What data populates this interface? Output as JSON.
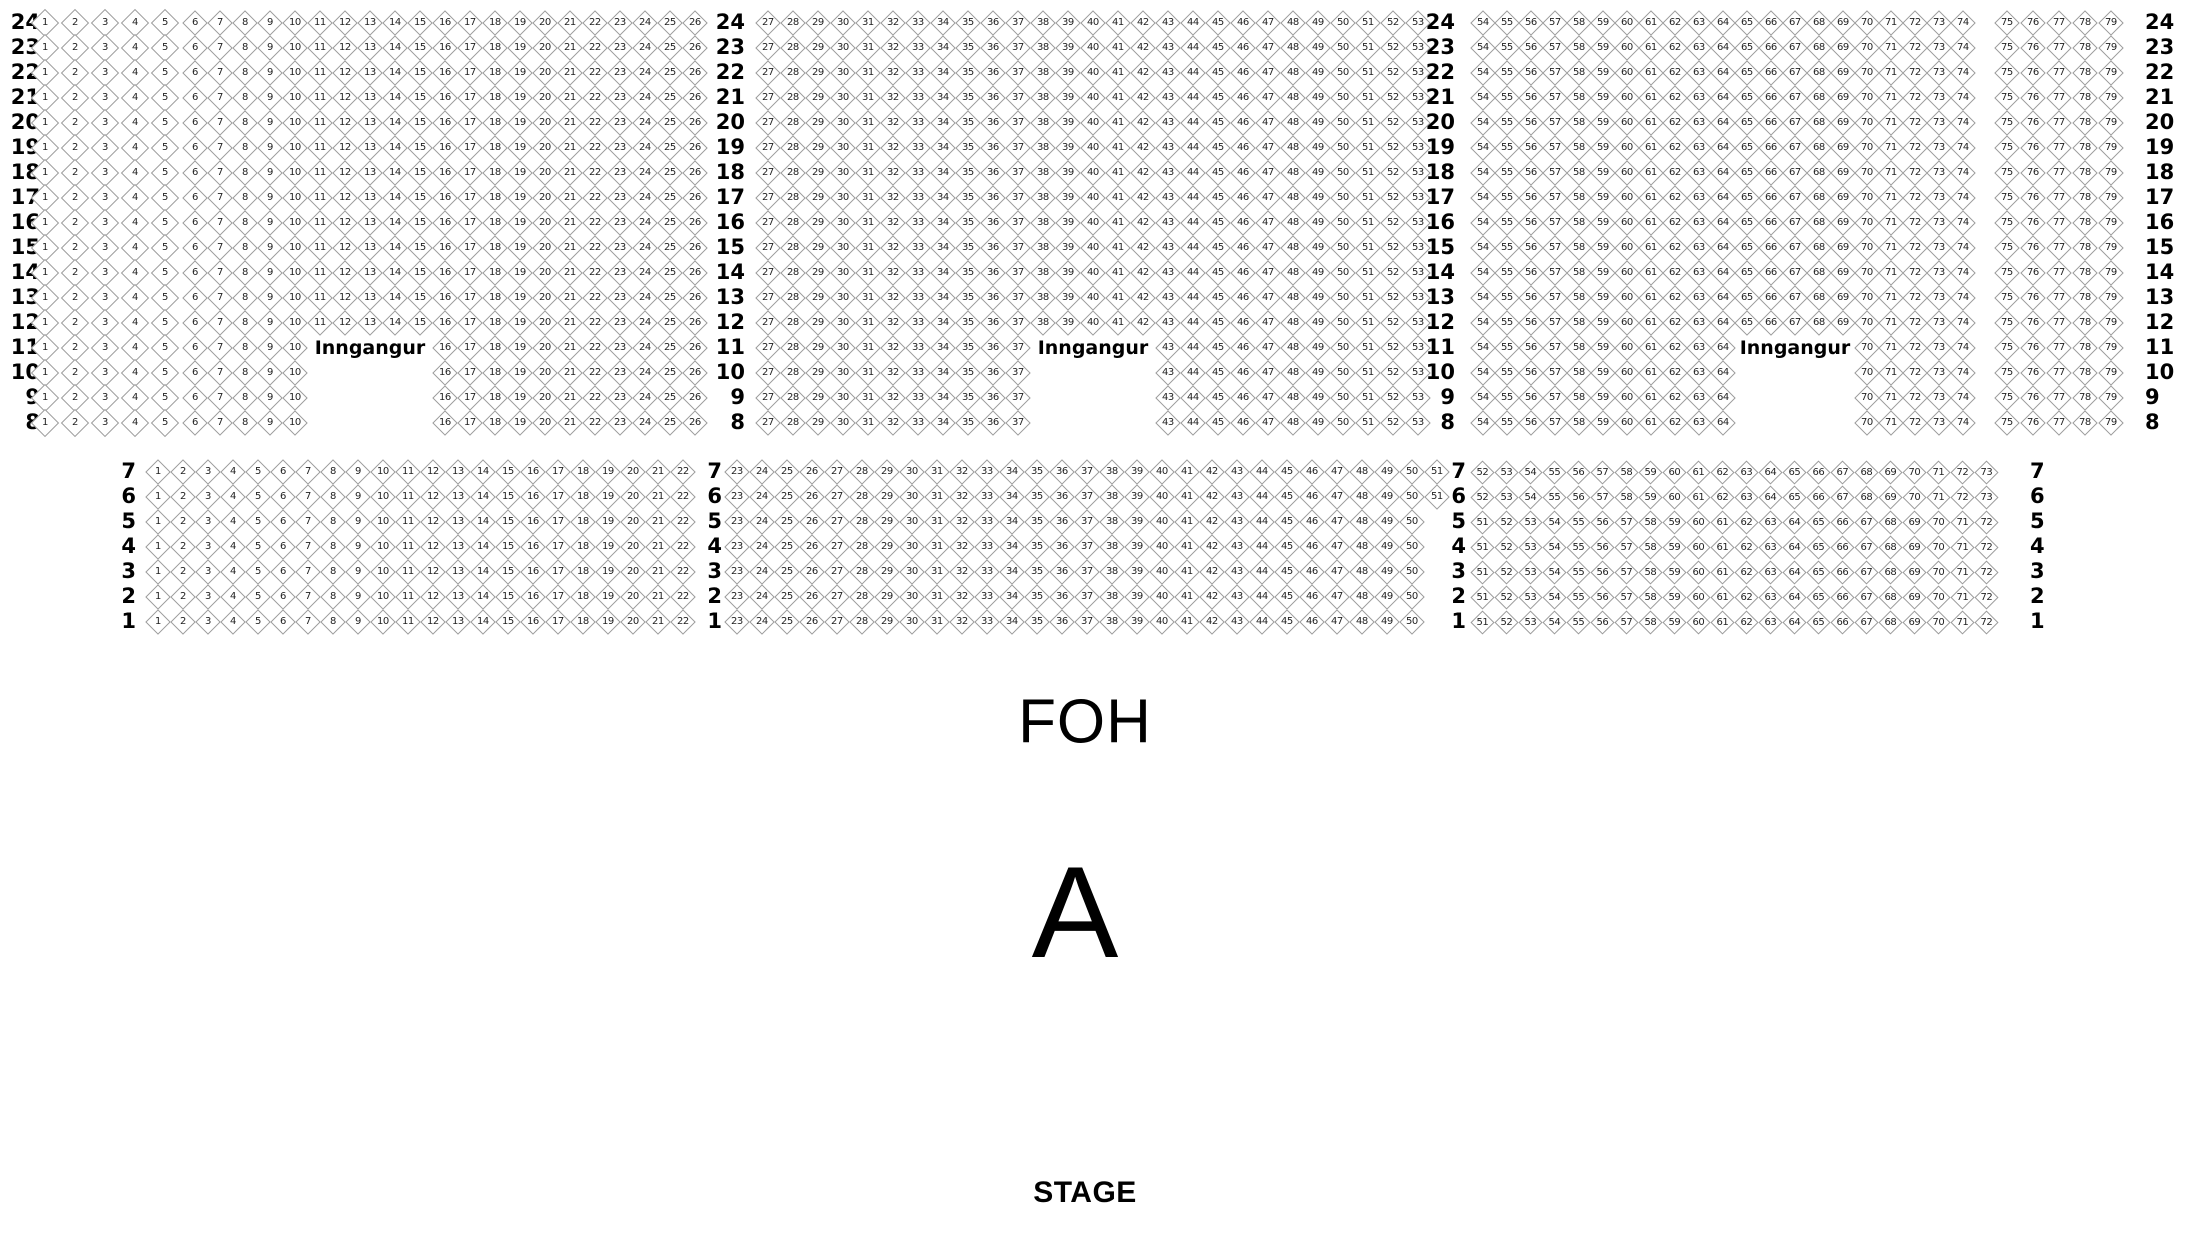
{
  "canvas": {
    "width": 2190,
    "height": 1260,
    "background": "#ffffff"
  },
  "labels": {
    "entrance": "Inngangur",
    "foh": "FOH",
    "section_letter": "A",
    "stage": "STAGE"
  },
  "colors": {
    "seat_border": "#9b9b9b",
    "seat_fill": "#ffffff",
    "seat_number": "#222222",
    "label_text": "#000000"
  },
  "upper_block": {
    "rows_from": 24,
    "rows_to": 8,
    "row_y0": 23,
    "row_dy": 25,
    "label_columns": [
      {
        "x": 40,
        "align": "right"
      },
      {
        "x": 745,
        "align": "right"
      },
      {
        "x": 1455,
        "align": "right"
      },
      {
        "x": 2145,
        "align": "left"
      }
    ],
    "sections": [
      {
        "id": "upper-left",
        "from": 1,
        "to": 5,
        "x0": 45,
        "dx": 30,
        "size": 20
      },
      {
        "id": "upper-mid-left",
        "from": 6,
        "to": 26,
        "x0": 195,
        "dx": 25,
        "size": 18,
        "gap": {
          "row_max": 11,
          "row_min": 8,
          "seats_from": 11,
          "seats_to": 15,
          "entrance_row": 11
        }
      },
      {
        "id": "upper-center",
        "from": 27,
        "to": 53,
        "x0": 768,
        "dx": 25,
        "size": 18,
        "gap": {
          "row_max": 11,
          "row_min": 8,
          "seats_from": 38,
          "seats_to": 42,
          "entrance_row": 11
        }
      },
      {
        "id": "upper-mid-right",
        "from": 54,
        "to": 74,
        "x0": 1483,
        "dx": 24,
        "size": 18,
        "gap": {
          "row_max": 11,
          "row_min": 8,
          "seats_from": 65,
          "seats_to": 69,
          "entrance_row": 11
        }
      },
      {
        "id": "upper-right",
        "from": 75,
        "to": 79,
        "x0": 2007,
        "dx": 26,
        "size": 18
      }
    ]
  },
  "lower_block": {
    "rows_from": 7,
    "rows_to": 1,
    "row_y0": 472,
    "row_dy": 25,
    "label_columns": [
      {
        "x": 136,
        "align": "right"
      },
      {
        "x": 722,
        "align": "right"
      },
      {
        "x": 1466,
        "align": "right"
      },
      {
        "x": 2030,
        "align": "left"
      }
    ],
    "sections": [
      {
        "id": "lower-left",
        "x0": 158,
        "dx": 25,
        "size": 18,
        "ranges": [
          {
            "rows": [
              7,
              6,
              5,
              4,
              3,
              2,
              1
            ],
            "from": 1,
            "to": 22
          }
        ]
      },
      {
        "id": "lower-center",
        "x0": 737,
        "dx": 25,
        "size": 18,
        "ranges": [
          {
            "rows": [
              7,
              6
            ],
            "from": 23,
            "to": 51
          },
          {
            "rows": [
              5,
              4,
              3,
              2,
              1
            ],
            "from": 23,
            "to": 50
          }
        ]
      },
      {
        "id": "lower-right",
        "x0": 1482,
        "dx": 24,
        "size": 17,
        "ranges": [
          {
            "rows": [
              7,
              6
            ],
            "from": 52,
            "to": 73
          },
          {
            "rows": [
              5,
              4,
              3,
              2,
              1
            ],
            "from": 51,
            "to": 72
          }
        ]
      }
    ]
  }
}
